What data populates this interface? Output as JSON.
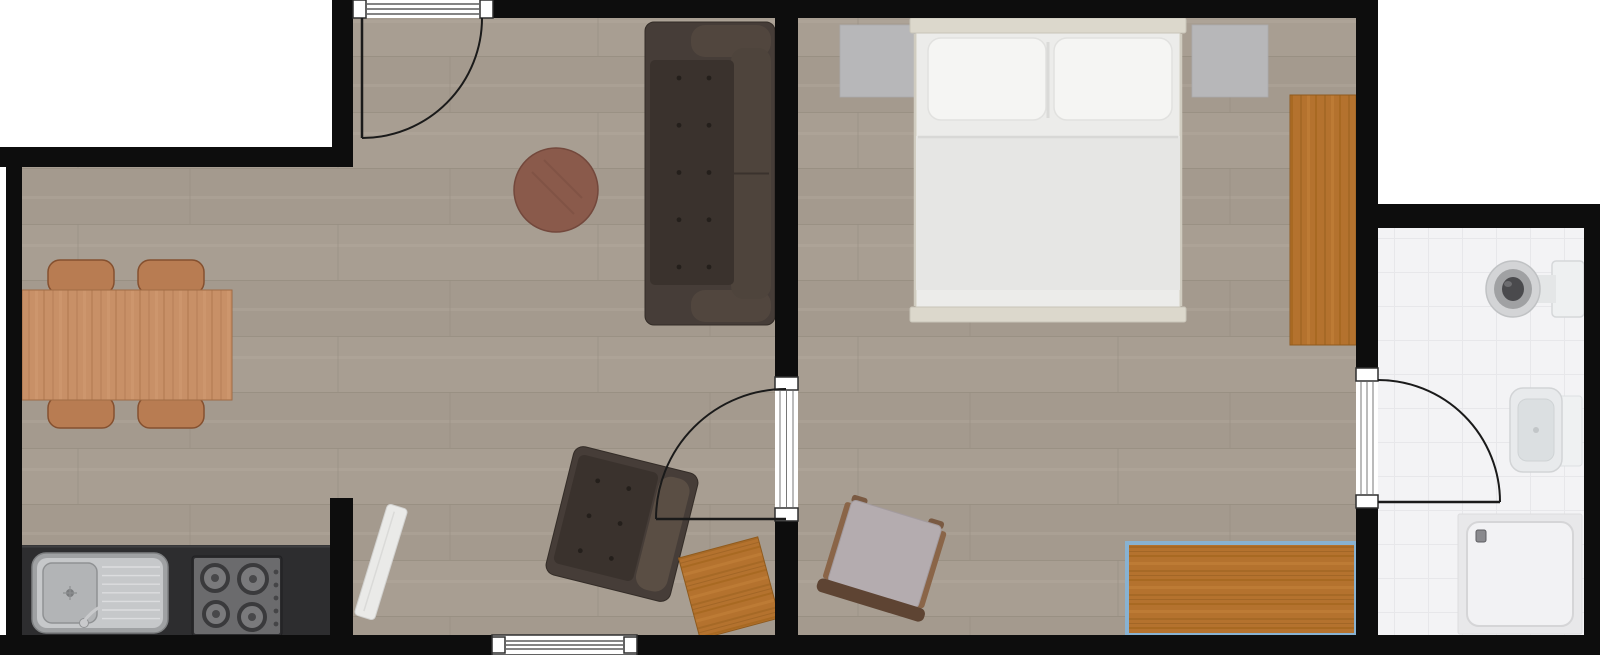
{
  "canvas": {
    "width": 1600,
    "height": 655,
    "background": "#ffffff"
  },
  "colors": {
    "wall": "#0d0d0d",
    "floor_base": "#a89e92",
    "floor_alt": "#a49a8e",
    "floor_line": "#968d81",
    "tile_base": "#f3f3f5",
    "tile_line": "#e7e7ea",
    "selection_blue": "#88b2d2",
    "sofa_base": "#463d38",
    "sofa_seat": "#3a322d",
    "sofa_cushion": "#51463e",
    "coffee_table": "#8a5a4b",
    "dining_wood": "#c89067",
    "chair_wood": "#b87c52",
    "counter": "#2d2d2f",
    "steel": "#c6c8ca",
    "stove_panel": "#6b6b6d",
    "orange_wood": "#b4722e",
    "mat_gray": "#b7b7b9",
    "bed_frame": "#dcd8cc",
    "mattress": "#ececea",
    "pillow": "#f5f5f3",
    "duvet": "#e6e6e4",
    "seat_gray": "#b4acaf",
    "frame_wood": "#8a6548",
    "back_rail": "#5e4433",
    "fixture_light": "#eef0f1",
    "door_line": "#1a1a1a",
    "opening_line": "#3a3a3a",
    "panel_white": "#eaeae8"
  },
  "floors": [
    {
      "name": "living-room-floor-upper",
      "rect": [
        353,
        18,
        422,
        617
      ],
      "pattern": "wood"
    },
    {
      "name": "living-room-floor-lower",
      "rect": [
        22,
        167,
        331,
        468
      ],
      "pattern": "wood"
    },
    {
      "name": "bedroom-floor",
      "rect": [
        798,
        18,
        558,
        617
      ],
      "pattern": "wood"
    },
    {
      "name": "bathroom-floor",
      "rect": [
        1378,
        228,
        206,
        407
      ],
      "pattern": "tile"
    }
  ],
  "walls": [
    {
      "name": "wall-top",
      "rect": [
        332,
        0,
        1046,
        18
      ]
    },
    {
      "name": "wall-topleft-vertical",
      "rect": [
        332,
        0,
        21,
        167
      ]
    },
    {
      "name": "wall-topleft-horizontal",
      "rect": [
        0,
        147,
        353,
        20
      ]
    },
    {
      "name": "wall-left",
      "rect": [
        6,
        147,
        16,
        508
      ]
    },
    {
      "name": "wall-bottom",
      "rect": [
        0,
        635,
        1600,
        20
      ]
    },
    {
      "name": "wall-living-bedroom",
      "rect": [
        775,
        0,
        23,
        655
      ]
    },
    {
      "name": "wall-bedroom-bathroom",
      "rect": [
        1356,
        0,
        22,
        655
      ]
    },
    {
      "name": "wall-bathroom-top",
      "rect": [
        1356,
        204,
        244,
        24
      ]
    },
    {
      "name": "wall-right",
      "rect": [
        1584,
        204,
        16,
        451
      ]
    },
    {
      "name": "wall-kitchen-stub",
      "rect": [
        330,
        498,
        23,
        157
      ]
    }
  ],
  "windows": [
    {
      "name": "window-living-bottom",
      "rect": [
        492,
        635,
        145,
        20
      ],
      "lines": 3,
      "jambs": [
        [
          492,
          637,
          13,
          16
        ],
        [
          624,
          637,
          13,
          16
        ]
      ]
    }
  ],
  "doors": [
    {
      "name": "entrance-door",
      "gap": [
        353,
        0,
        140,
        18
      ],
      "gap_lines": "h3",
      "jambs": [
        [
          353,
          0,
          13,
          18
        ],
        [
          480,
          0,
          13,
          18
        ]
      ],
      "leaf": [
        [
          362,
          18
        ],
        [
          362,
          138
        ]
      ],
      "arc": "M 482 18 A 120 120 0 0 1 362 138"
    },
    {
      "name": "bedroom-door",
      "gap": [
        775,
        377,
        23,
        144
      ],
      "gap_lines": "v3",
      "jambs": [
        [
          775,
          377,
          23,
          13
        ],
        [
          775,
          508,
          23,
          13
        ]
      ],
      "leaf": [
        [
          786,
          519
        ],
        [
          656,
          519
        ]
      ],
      "arc": "M 656 519 A 130 130 0 0 1 786 389"
    },
    {
      "name": "bathroom-door",
      "gap": [
        1356,
        368,
        22,
        140
      ],
      "gap_lines": "v3",
      "jambs": [
        [
          1356,
          368,
          22,
          13
        ],
        [
          1356,
          495,
          22,
          13
        ]
      ],
      "leaf": [
        [
          1378,
          502
        ],
        [
          1500,
          502
        ]
      ],
      "arc": "M 1378 380 A 122 122 0 0 1 1500 502"
    }
  ],
  "furniture": [
    {
      "type": "mat",
      "name": "bedside-mat-left",
      "x": 840,
      "y": 25,
      "w": 76,
      "h": 72
    },
    {
      "type": "mat",
      "name": "bedside-mat-right",
      "x": 1192,
      "y": 25,
      "w": 76,
      "h": 72
    },
    {
      "type": "wood_rect",
      "name": "wardrobe",
      "x": 1290,
      "y": 95,
      "w": 66,
      "h": 250,
      "grain": "v",
      "selected": false
    },
    {
      "type": "bed",
      "name": "double-bed",
      "x": 912,
      "y": 18,
      "w": 272,
      "h": 304
    },
    {
      "type": "dining_set",
      "name": "dining-set",
      "table": [
        22,
        290,
        210,
        110
      ],
      "chairs": [
        [
          48,
          260,
          66,
          34
        ],
        [
          138,
          260,
          66,
          34
        ],
        [
          48,
          396,
          66,
          32
        ],
        [
          138,
          396,
          66,
          32
        ]
      ]
    },
    {
      "type": "counter",
      "name": "kitchen-counter",
      "x": 22,
      "y": 545,
      "w": 308,
      "h": 92
    },
    {
      "type": "sink",
      "name": "kitchen-sink",
      "x": 32,
      "y": 553,
      "w": 136,
      "h": 80
    },
    {
      "type": "stove",
      "name": "stove-cooktop",
      "x": 192,
      "y": 556,
      "w": 90,
      "h": 80
    },
    {
      "type": "round_table",
      "name": "coffee-table",
      "cx": 556,
      "cy": 190,
      "r": 42
    },
    {
      "type": "sofa",
      "name": "sofa",
      "x": 645,
      "y": 22,
      "w": 130,
      "h": 303
    },
    {
      "type": "panel",
      "name": "leaning-white-panel",
      "cx": 381,
      "cy": 562,
      "w": 21,
      "h": 116,
      "rot": 17
    },
    {
      "type": "armchair",
      "name": "armchair",
      "cx": 622,
      "cy": 524,
      "w": 128,
      "h": 132,
      "rot": 14
    },
    {
      "type": "wood_rect",
      "name": "side-table",
      "cx": 729,
      "cy": 588,
      "w": 82,
      "h": 84,
      "rot": -15,
      "grain": "h",
      "selected": false
    },
    {
      "type": "chair",
      "name": "bedroom-chair",
      "cx": 884,
      "cy": 557,
      "w": 94,
      "h": 92,
      "rot": 17
    },
    {
      "type": "wood_rect",
      "name": "desk-selected",
      "x": 1127,
      "y": 543,
      "w": 229,
      "h": 92,
      "grain": "h",
      "selected": true
    },
    {
      "type": "toilet",
      "name": "toilet",
      "cx": 1513,
      "cy": 289
    },
    {
      "type": "basin",
      "name": "washbasin",
      "x": 1510,
      "y": 388
    },
    {
      "type": "shower",
      "name": "shower-tray",
      "x": 1458,
      "y": 514,
      "w": 124,
      "h": 120
    }
  ]
}
